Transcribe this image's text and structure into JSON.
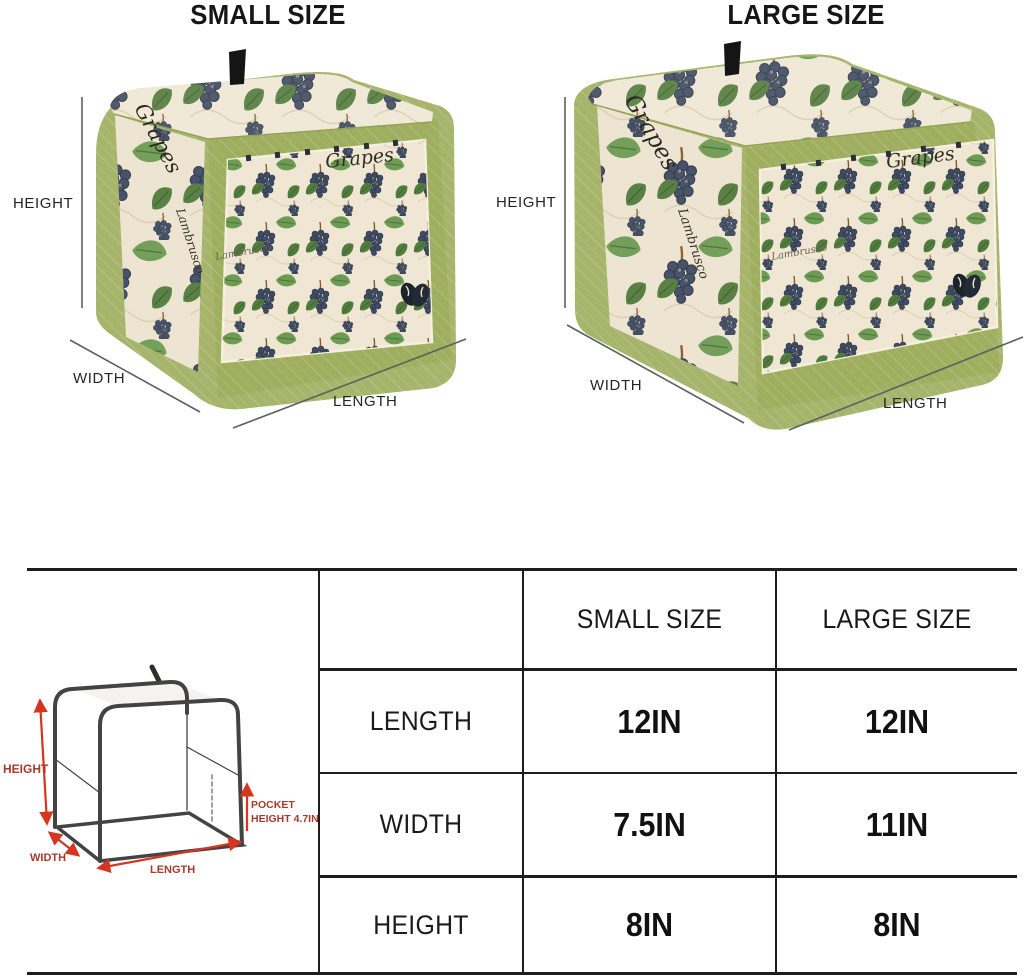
{
  "products": {
    "small": {
      "title": "SMALL SIZE",
      "dim_height": "HEIGHT",
      "dim_width": "WIDTH",
      "dim_length": "LENGTH"
    },
    "large": {
      "title": "LARGE SIZE",
      "dim_height": "HEIGHT",
      "dim_width": "WIDTH",
      "dim_length": "LENGTH"
    },
    "fabric": {
      "script_front": "Grapes",
      "script_side": "Grapes",
      "script_side_2": "Lambrusco",
      "script_front_small": "Lambrusco"
    }
  },
  "sketch": {
    "height_label": "HEIGHT",
    "width_label": "WIDTH",
    "length_label": "LENGTH",
    "pocket_label_line1": "POCKET",
    "pocket_label_line2": "HEIGHT 4.7IN"
  },
  "size_table": {
    "col_headers": {
      "small": "SMALL SIZE",
      "large": "LARGE SIZE"
    },
    "rows": [
      {
        "label": "LENGTH",
        "small": "12IN",
        "large": "12IN"
      },
      {
        "label": "WIDTH",
        "small": "7.5IN",
        "large": "11IN"
      },
      {
        "label": "HEIGHT",
        "small": "8IN",
        "large": "8IN"
      }
    ]
  },
  "colors": {
    "trim_green": "#a6b56b",
    "front_green": "#9fae5f",
    "panel_cream": "#ede5d1",
    "grape_navy": "#3f4b63",
    "leaf_green": "#6d9b54",
    "accent_red": "#d6351f",
    "label_red": "#a8392b",
    "table_line": "#1d1d1d"
  }
}
